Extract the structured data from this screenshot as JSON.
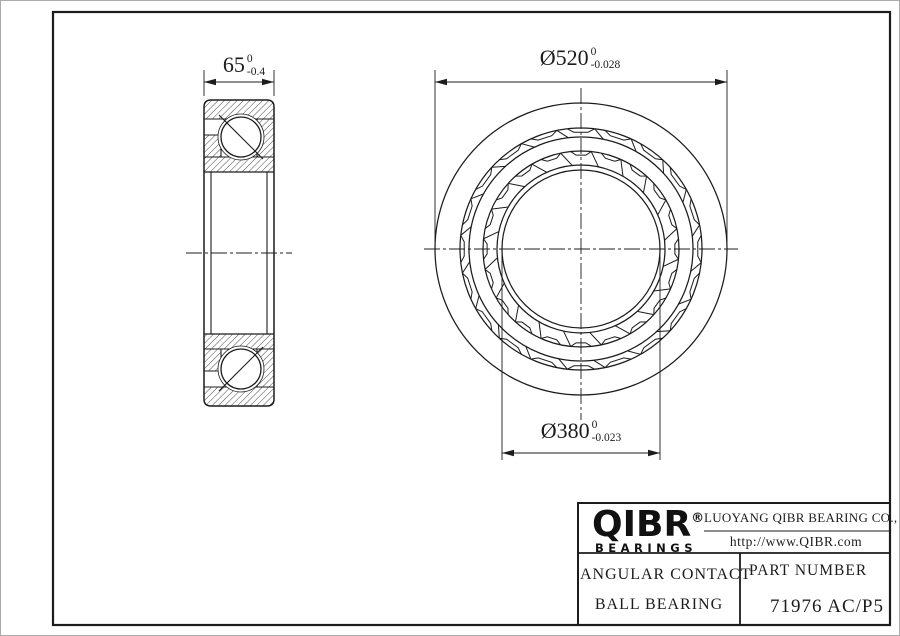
{
  "dimensions": {
    "width": {
      "value": "65",
      "tol_upper": "0",
      "tol_lower": "-0.4"
    },
    "outer_diameter": {
      "value": "Ø520",
      "tol_upper": "0",
      "tol_lower": "-0.028"
    },
    "bore_diameter": {
      "value": "Ø380",
      "tol_upper": "0",
      "tol_lower": "-0.023"
    }
  },
  "title_block": {
    "brand": "QIBR",
    "brand_registered_mark": "®",
    "brand_sub": "BEARINGS",
    "company": "LUOYANG QIBR BEARING CO., LTD",
    "website": "http://www.QIBR.com",
    "product_line1": "ANGULAR CONTACT",
    "product_line2": "BALL BEARING",
    "part_number_label": "PART NUMBER",
    "part_number": "71976 AC/P5"
  },
  "colors": {
    "line_color": "#1c1c1c",
    "background": "#ffffff"
  }
}
